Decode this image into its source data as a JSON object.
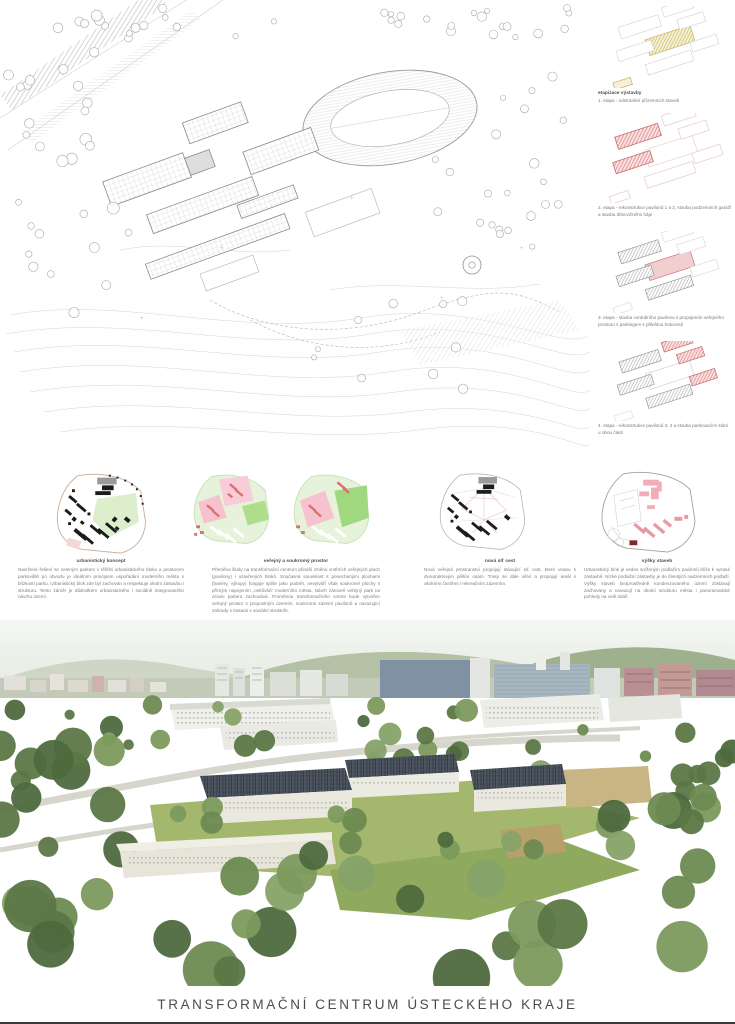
{
  "board": {
    "title": "TRANSFORMAČNÍ CENTRUM ÚSTECKÉHO KRAJE"
  },
  "phases": {
    "heading": "etapizace výstavby",
    "items": [
      {
        "caption": "1. etapa - odstranění přízemních staveb"
      },
      {
        "caption": "2. etapa - rekonstrukce pavilonů 1 a 2, stavba podzemních garáží a stavba tělocvičného háje"
      },
      {
        "caption": "3. etapa - stavba centrálního pavilonu s propojením veřejného prostoru s parkingem s přilehlou hotovostí"
      },
      {
        "caption": "4. etapa - rekonstrukce pavilonů 3, 4 a stavba parkovacích stání u obou částí"
      }
    ]
  },
  "concepts": [
    {
      "heading": "urbanistický koncept",
      "body": "Navržené řešení se zeleným parkem v těžišti urbanistického bloku a prostorem parkoviště po obvodu je ideálním principem uspořádání moderního města s blízkostí parku. Urbanistický blok zde byl zachován a respektuje okolní zástavbu i strukturu. Tento záměr je důsledkem urbanistického i sociálně integrovaného návrhu území."
    },
    {
      "heading": "veřejný a soukromý prostor",
      "body": "Přeměna školy na transformační centrum přináší změnu vnitřních veřejných ploch (pavilony) i uzavřených bloků. Současná souvislost s ponechanými plochami (bariéry, výkopy) funguje spíše jako podnět, nevytváří však soukromé plochy s přímým napojením „ostrůvků“ moderního města. Návrh zároveň veřejný park na úrovni parteru zachovává. Proměnou transformačního centra bude vytvořen veřejný prostor s propustným územím, soukromá zázemí pavilonů a navazující zahrady s trasami v sociální struktuře."
    },
    {
      "heading": "nová síť cest",
      "body": "Nová veřejná prostranství propojují stávající síť cest, které vedou k dvoutraktovým pěším osám. Trasy se dále větví a propojují areál s okolními čtvrtěmi i rekreačním zázemím."
    },
    {
      "heading": "výšky staveb",
      "body": "Urbanistický blok je veden sníženým podlažím pavilonů blíže k vysoké zástavbě. Nízké podlažní zástavby je do členitých nadzemních podlaží. Výšky staveb bezprostředně kondenzovaného území zůstávají zachovány a navazují na okolní strukturu města i panoramatické pohledy na celé údolí."
    }
  ],
  "colors": {
    "accent_red": "#d97b7b",
    "accent_pink": "#f7c6d0",
    "accent_green": "#cfe8bd",
    "accent_yellow": "#c8b44f",
    "title_gray": "#4b4b4b"
  }
}
